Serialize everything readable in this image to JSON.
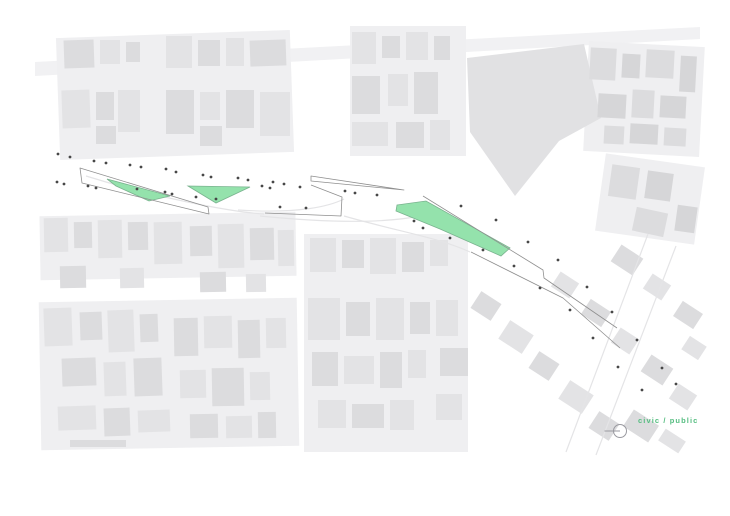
{
  "page": {
    "background": "#ffffff"
  },
  "legend": {
    "label": "civic / public",
    "color": "#55bd80"
  },
  "marker": {
    "stroke": "#9a9aa0"
  },
  "map": {
    "colors": {
      "street_band": "#f1f1f3",
      "underlay": "#efeff1",
      "building_light": "#e3e3e5",
      "building_mid": "#dcdcde",
      "building_dark": "#d6d6d8",
      "big_block": "#e1e1e3",
      "green_fill": "#94e2ac",
      "green_stroke": "#7ab38f",
      "line": "#8f8f8f",
      "faint_line": "#e4e4e6",
      "dot": "#474747"
    },
    "street_band": "35,62 700,27 700,39 35,76",
    "big_block": "467,58 584,44 601,118 559,141 515,196 470,132",
    "underlays": [
      [
        58,
        34,
        234,
        122,
        -2
      ],
      [
        350,
        26,
        116,
        130,
        0
      ],
      [
        40,
        214,
        256,
        64,
        -1
      ],
      [
        40,
        300,
        258,
        148,
        -1
      ],
      [
        304,
        234,
        164,
        218,
        0
      ],
      [
        586,
        44,
        116,
        110,
        3
      ],
      [
        600,
        160,
        100,
        78,
        8
      ]
    ],
    "buildings": [
      [
        64,
        40,
        30,
        28,
        2,
        -2
      ],
      [
        100,
        40,
        20,
        24,
        1,
        0
      ],
      [
        126,
        42,
        14,
        20,
        2,
        0
      ],
      [
        166,
        36,
        26,
        32,
        1,
        0
      ],
      [
        198,
        40,
        22,
        26,
        2,
        0
      ],
      [
        226,
        38,
        18,
        28,
        1,
        0
      ],
      [
        250,
        40,
        36,
        26,
        2,
        -2
      ],
      [
        62,
        90,
        28,
        38,
        1,
        -2
      ],
      [
        96,
        92,
        18,
        28,
        2,
        0
      ],
      [
        118,
        90,
        22,
        42,
        1,
        0
      ],
      [
        166,
        90,
        28,
        44,
        2,
        0
      ],
      [
        200,
        92,
        20,
        28,
        1,
        0
      ],
      [
        226,
        90,
        28,
        38,
        2,
        0
      ],
      [
        260,
        92,
        30,
        44,
        1,
        0
      ],
      [
        96,
        126,
        20,
        18,
        2,
        0
      ],
      [
        200,
        126,
        22,
        20,
        2,
        0
      ],
      [
        352,
        32,
        24,
        32,
        1,
        0
      ],
      [
        382,
        36,
        18,
        22,
        2,
        0
      ],
      [
        406,
        32,
        22,
        28,
        1,
        0
      ],
      [
        434,
        36,
        16,
        24,
        2,
        0
      ],
      [
        352,
        76,
        28,
        38,
        2,
        0
      ],
      [
        388,
        74,
        20,
        32,
        1,
        0
      ],
      [
        414,
        72,
        24,
        42,
        2,
        0
      ],
      [
        352,
        122,
        36,
        24,
        1,
        0
      ],
      [
        396,
        122,
        28,
        26,
        2,
        0
      ],
      [
        430,
        120,
        20,
        30,
        1,
        0
      ],
      [
        590,
        48,
        26,
        32,
        2,
        3
      ],
      [
        622,
        54,
        18,
        24,
        3,
        3
      ],
      [
        646,
        50,
        28,
        28,
        2,
        3
      ],
      [
        680,
        56,
        16,
        36,
        3,
        3
      ],
      [
        598,
        94,
        28,
        24,
        3,
        3
      ],
      [
        632,
        90,
        22,
        28,
        2,
        3
      ],
      [
        660,
        96,
        26,
        22,
        3,
        3
      ],
      [
        604,
        126,
        20,
        18,
        2,
        3
      ],
      [
        630,
        124,
        28,
        20,
        3,
        3
      ],
      [
        664,
        128,
        22,
        18,
        2,
        3
      ],
      [
        610,
        166,
        28,
        32,
        2,
        8
      ],
      [
        646,
        172,
        26,
        28,
        3,
        8
      ],
      [
        634,
        210,
        32,
        24,
        2,
        12
      ],
      [
        676,
        206,
        20,
        26,
        3,
        8
      ],
      [
        44,
        218,
        24,
        34,
        1,
        -1
      ],
      [
        74,
        222,
        18,
        26,
        2,
        -1
      ],
      [
        98,
        220,
        24,
        38,
        1,
        -1
      ],
      [
        128,
        222,
        20,
        28,
        2,
        -1
      ],
      [
        154,
        222,
        28,
        42,
        1,
        -1
      ],
      [
        190,
        226,
        22,
        30,
        2,
        -1
      ],
      [
        218,
        224,
        26,
        44,
        1,
        -1
      ],
      [
        250,
        228,
        24,
        32,
        2,
        -1
      ],
      [
        278,
        230,
        16,
        36,
        1,
        -1
      ],
      [
        60,
        266,
        26,
        22,
        2,
        -1
      ],
      [
        120,
        268,
        24,
        20,
        1,
        -1
      ],
      [
        200,
        272,
        26,
        20,
        2,
        -1
      ],
      [
        246,
        274,
        20,
        18,
        1,
        -1
      ],
      [
        310,
        238,
        26,
        34,
        1,
        0
      ],
      [
        342,
        240,
        22,
        28,
        2,
        0
      ],
      [
        370,
        238,
        26,
        36,
        1,
        0
      ],
      [
        402,
        242,
        22,
        30,
        2,
        0
      ],
      [
        430,
        240,
        18,
        26,
        1,
        0
      ],
      [
        44,
        308,
        28,
        38,
        1,
        -2
      ],
      [
        80,
        312,
        22,
        28,
        2,
        -2
      ],
      [
        108,
        310,
        26,
        42,
        1,
        -2
      ],
      [
        140,
        314,
        18,
        28,
        2,
        -2
      ],
      [
        62,
        358,
        34,
        28,
        2,
        -2
      ],
      [
        104,
        362,
        22,
        34,
        1,
        -2
      ],
      [
        134,
        358,
        28,
        38,
        2,
        -2
      ],
      [
        58,
        406,
        38,
        24,
        1,
        -2
      ],
      [
        104,
        408,
        26,
        28,
        2,
        -2
      ],
      [
        138,
        410,
        32,
        22,
        1,
        -2
      ],
      [
        70,
        440,
        56,
        7,
        2,
        0
      ],
      [
        174,
        318,
        24,
        38,
        2,
        -1
      ],
      [
        204,
        316,
        28,
        32,
        1,
        -1
      ],
      [
        238,
        320,
        22,
        38,
        2,
        -1
      ],
      [
        266,
        318,
        20,
        30,
        1,
        -1
      ],
      [
        180,
        370,
        26,
        28,
        1,
        -1
      ],
      [
        212,
        368,
        32,
        38,
        2,
        -1
      ],
      [
        250,
        372,
        20,
        28,
        1,
        -1
      ],
      [
        190,
        414,
        28,
        24,
        2,
        -1
      ],
      [
        226,
        416,
        26,
        22,
        1,
        -1
      ],
      [
        258,
        412,
        18,
        26,
        2,
        -1
      ],
      [
        308,
        298,
        32,
        42,
        1,
        0
      ],
      [
        346,
        302,
        24,
        34,
        2,
        0
      ],
      [
        376,
        298,
        28,
        42,
        1,
        0
      ],
      [
        410,
        302,
        20,
        32,
        2,
        0
      ],
      [
        312,
        352,
        26,
        34,
        2,
        0
      ],
      [
        344,
        356,
        30,
        28,
        1,
        0
      ],
      [
        380,
        352,
        22,
        36,
        2,
        0
      ],
      [
        408,
        350,
        18,
        28,
        1,
        0
      ],
      [
        318,
        400,
        28,
        28,
        1,
        0
      ],
      [
        352,
        404,
        32,
        24,
        2,
        0
      ],
      [
        390,
        400,
        24,
        30,
        1,
        0
      ],
      [
        436,
        300,
        22,
        36,
        1,
        0
      ],
      [
        440,
        348,
        28,
        28,
        2,
        0
      ],
      [
        436,
        394,
        26,
        26,
        1,
        0
      ],
      [
        474,
        296,
        24,
        20,
        2,
        33
      ],
      [
        502,
        326,
        28,
        22,
        1,
        33
      ],
      [
        532,
        356,
        24,
        20,
        2,
        33
      ],
      [
        562,
        386,
        28,
        22,
        1,
        33
      ],
      [
        592,
        416,
        24,
        20,
        2,
        33
      ],
      [
        554,
        276,
        22,
        18,
        1,
        33
      ],
      [
        584,
        304,
        24,
        18,
        2,
        33
      ],
      [
        614,
        332,
        22,
        18,
        1,
        33
      ],
      [
        644,
        360,
        26,
        20,
        2,
        33
      ],
      [
        672,
        388,
        22,
        18,
        1,
        33
      ],
      [
        614,
        250,
        26,
        20,
        2,
        33
      ],
      [
        646,
        278,
        22,
        18,
        1,
        33
      ],
      [
        676,
        306,
        24,
        18,
        2,
        33
      ],
      [
        684,
        340,
        20,
        16,
        1,
        33
      ],
      [
        626,
        416,
        30,
        20,
        2,
        33
      ],
      [
        660,
        434,
        24,
        14,
        1,
        33
      ]
    ],
    "faint_lines": [
      "M86,176 C150,196 230,212 264,214",
      "M238,210 C300,214 330,206 344,199",
      "M260,216 C320,222 380,224 420,216",
      "M344,216 C400,232 440,238 470,252",
      "M648,234 L566,452",
      "M676,246 L596,455"
    ],
    "green_areas": [
      "107,179 170,196 149,201 116,186",
      "188,186 250,187 216,203",
      "397,205 426,201 510,248 501,256 440,229 396,211"
    ],
    "outline_paths": [
      "M80,168 L208,207 L209,214 L82,183 Z",
      "M311,176 L404,190 L311,181 Z",
      "M265,213 L341,216 L342,197 L311,185",
      "M423,196 L543,270 L544,278 L617,328",
      "M471,252 L563,298 L620,348"
    ],
    "dots": [
      [
        58,
        154
      ],
      [
        70,
        157
      ],
      [
        94,
        161
      ],
      [
        106,
        163
      ],
      [
        130,
        165
      ],
      [
        141,
        167
      ],
      [
        166,
        169
      ],
      [
        176,
        172
      ],
      [
        203,
        175
      ],
      [
        211,
        177
      ],
      [
        238,
        178
      ],
      [
        248,
        180
      ],
      [
        273,
        182
      ],
      [
        284,
        184
      ],
      [
        300,
        187
      ],
      [
        57,
        182
      ],
      [
        64,
        184
      ],
      [
        88,
        186
      ],
      [
        96,
        188
      ],
      [
        137,
        189
      ],
      [
        165,
        192
      ],
      [
        172,
        194
      ],
      [
        196,
        197
      ],
      [
        216,
        199
      ],
      [
        262,
        186
      ],
      [
        270,
        188
      ],
      [
        280,
        207
      ],
      [
        306,
        208
      ],
      [
        345,
        191
      ],
      [
        355,
        193
      ],
      [
        377,
        195
      ],
      [
        414,
        221
      ],
      [
        423,
        228
      ],
      [
        450,
        238
      ],
      [
        461,
        206
      ],
      [
        483,
        250
      ],
      [
        496,
        220
      ],
      [
        514,
        266
      ],
      [
        528,
        242
      ],
      [
        540,
        288
      ],
      [
        558,
        260
      ],
      [
        570,
        310
      ],
      [
        587,
        287
      ],
      [
        593,
        338
      ],
      [
        612,
        312
      ],
      [
        618,
        367
      ],
      [
        637,
        340
      ],
      [
        642,
        390
      ],
      [
        662,
        368
      ],
      [
        676,
        384
      ]
    ]
  }
}
